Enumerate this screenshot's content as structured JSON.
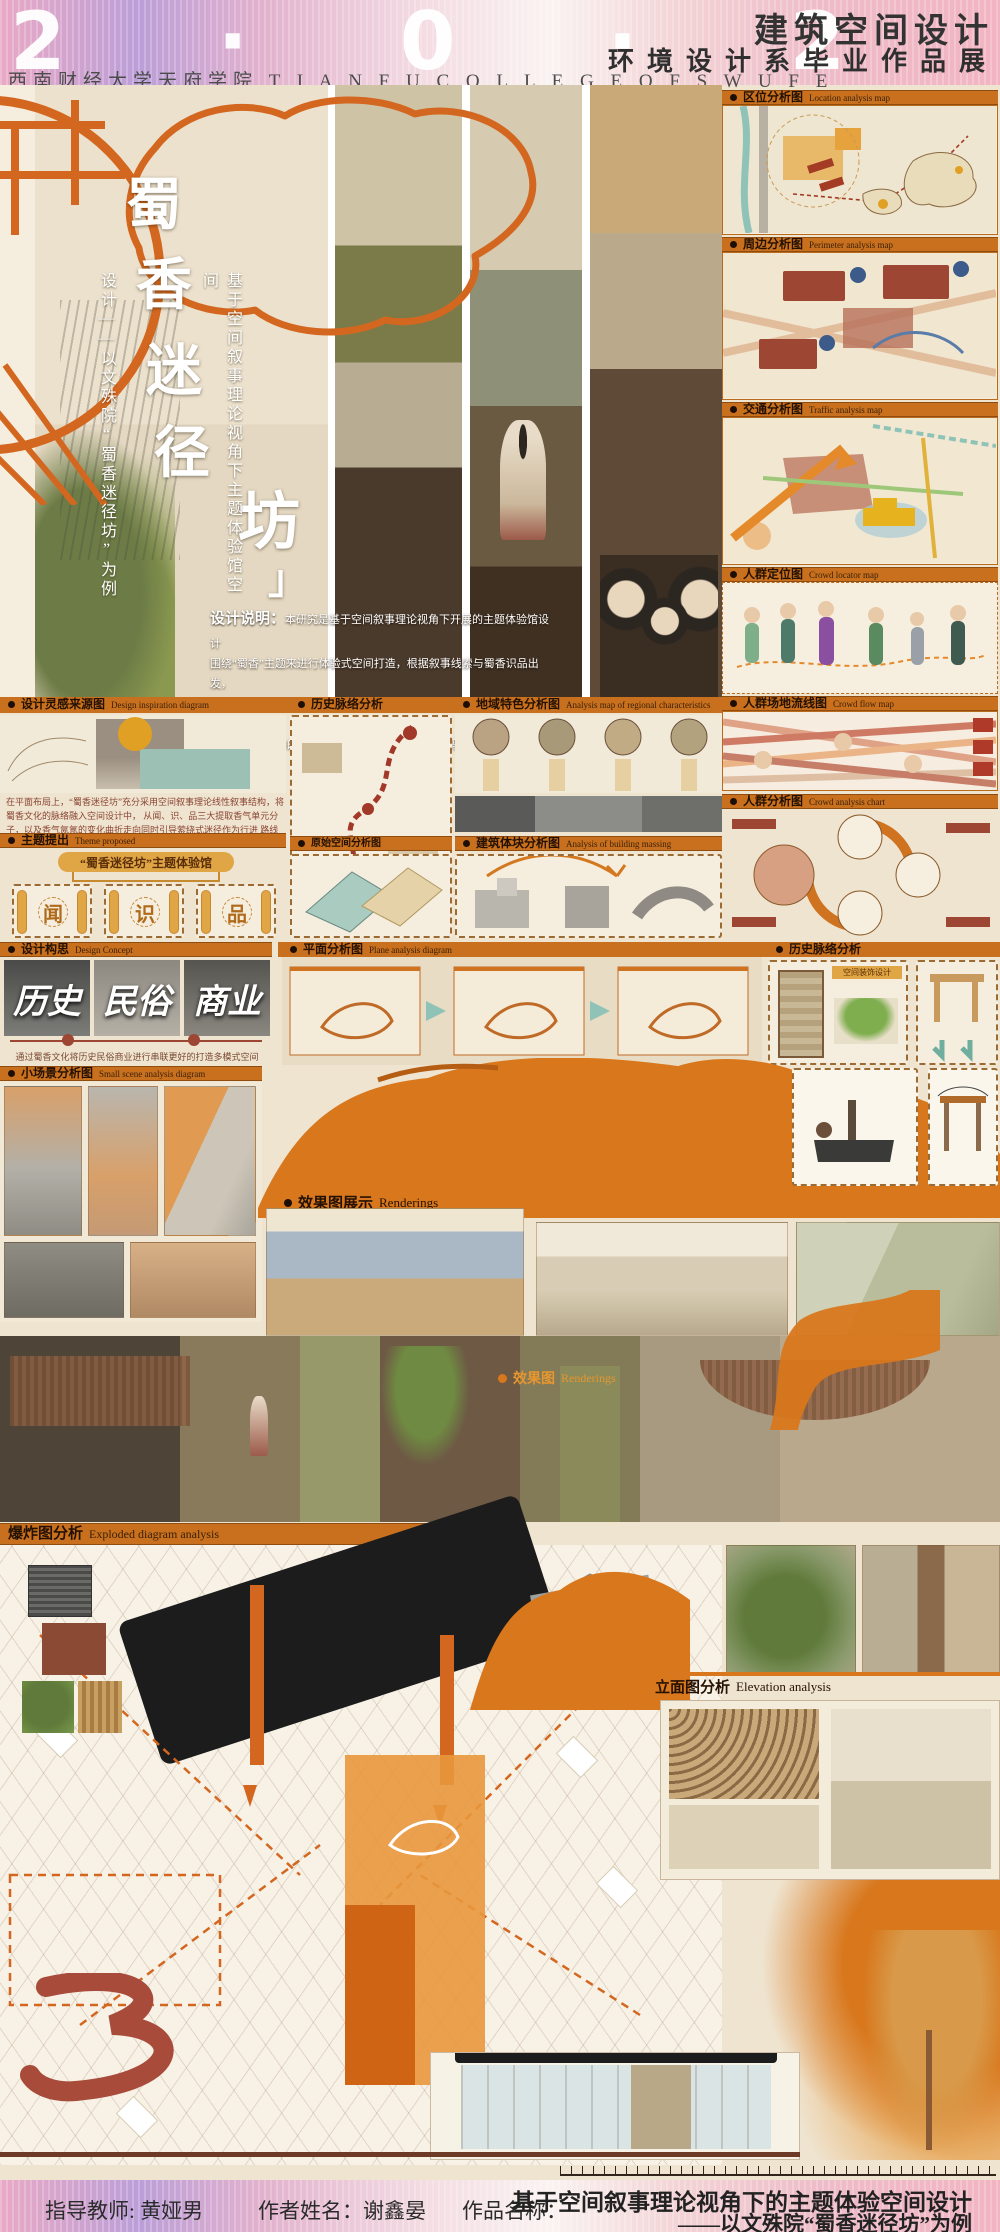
{
  "header": {
    "year": "2 · 0 · 2 · 5",
    "title_main": "建筑空间设计",
    "title_sub": "环境设计系毕业作品展",
    "school": "西南财经大学天府学院 T I A N F U   C O L L E G E   O F   S W U F E"
  },
  "hero": {
    "title_chars": [
      "蜀",
      "香",
      "迷",
      "径",
      "坊"
    ],
    "title_bracket": "」",
    "subtitle_right": "基于空间叙事理论视角下主题体验馆空间",
    "subtitle_left": "设计——以文殊院“蜀香迷径坊”为例",
    "desc_label": "设计说明：",
    "desc_line1": "本研究是基于空间叙事理论视角下开展的主题体验馆设计",
    "desc_line2": "围绕“蜀香”主题来进行体验式空间打造，根据叙事线索与蜀香识品出发，",
    "desc_line3": "围绕闻、识、品三大关键要素展开进行每层设计，引领游客在对蜀香空间的体",
    "desc_line4": "验下产生对蜀香的深刻了解以及得到最大满足的体验。"
  },
  "right_column": {
    "cards": [
      {
        "title": "区位分析图",
        "subtitle": "Location analysis map"
      },
      {
        "title": "周边分析图",
        "subtitle": "Perimeter analysis map"
      },
      {
        "title": "交通分析图",
        "subtitle": "Traffic analysis map"
      },
      {
        "title": "人群定位图",
        "subtitle": "Crowd locator map"
      },
      {
        "title": "人群场地流线图",
        "subtitle": "Crowd flow map"
      },
      {
        "title": "人群分析图",
        "subtitle": "Crowd analysis chart"
      }
    ]
  },
  "sections": {
    "inspiration": {
      "title": "设计灵感来源图",
      "subtitle": "Design inspiration diagram"
    },
    "history": {
      "title": "历史脉络分析",
      "subtitle": "Design inspiration diagram"
    },
    "regional": {
      "title": "地域特色分析图",
      "subtitle": "Analysis map of regional characteristics"
    },
    "theme": {
      "title": "主题提出",
      "subtitle": "Theme proposed"
    },
    "original_space": {
      "title": "原始空间分析图",
      "subtitle": "Original spatial analysis diagram"
    },
    "massing": {
      "title": "建筑体块分析图",
      "subtitle": "Analysis of building massing"
    },
    "concept": {
      "title": "设计构思",
      "subtitle": "Design Concept"
    },
    "plane": {
      "title": "平面分析图",
      "subtitle": "Plane analysis diagram"
    },
    "history2": {
      "title": "历史脉络分析",
      "subtitle": ""
    },
    "small_scene": {
      "title": "小场景分析图",
      "subtitle": "Small scene analysis diagram"
    },
    "render_show": {
      "title": "效果图展示",
      "subtitle": "Renderings"
    },
    "render": {
      "title": "效果图",
      "subtitle": "Renderings"
    },
    "exploded": {
      "title": "爆炸图分析",
      "subtitle": "Exploded diagram analysis"
    },
    "elevation": {
      "title": "立面图分析",
      "subtitle": "Elevation analysis"
    }
  },
  "theme_block": {
    "para_line1": "在平面布局上，“蜀香迷径坊”充分采用空间叙事理论线性叙事结构，将蜀香文化的脉络融入空间设计中，",
    "para_line2": "从闻、识、品三大提取香气单元分子，以及香气氤氲的变化曲折走向同时引导萦绕式迷径作为行进",
    "para_line3": "路线组织的空间，天花采用圆形或流线型的曲线来进行布局设计。",
    "banner": "“蜀香迷径坊”主题体验馆",
    "units": [
      "闻",
      "识",
      "品"
    ]
  },
  "concept_block": {
    "photos": [
      "历史",
      "民俗",
      "商业"
    ],
    "caption": "通过蜀香文化将历史民俗商业进行串联更好的打造多模式空间"
  },
  "misc": {
    "decor_tag": "空间装饰设计",
    "big_numeral": "3"
  },
  "footer": {
    "advisor": "指导教师: 黄娅男",
    "author": "作者姓名：谢鑫晏",
    "work_label": "作品名称：",
    "work_line1": "基于空间叙事理论视角下的主题体验空间设计",
    "work_line2": "——以文殊院“蜀香迷径坊”为例"
  }
}
